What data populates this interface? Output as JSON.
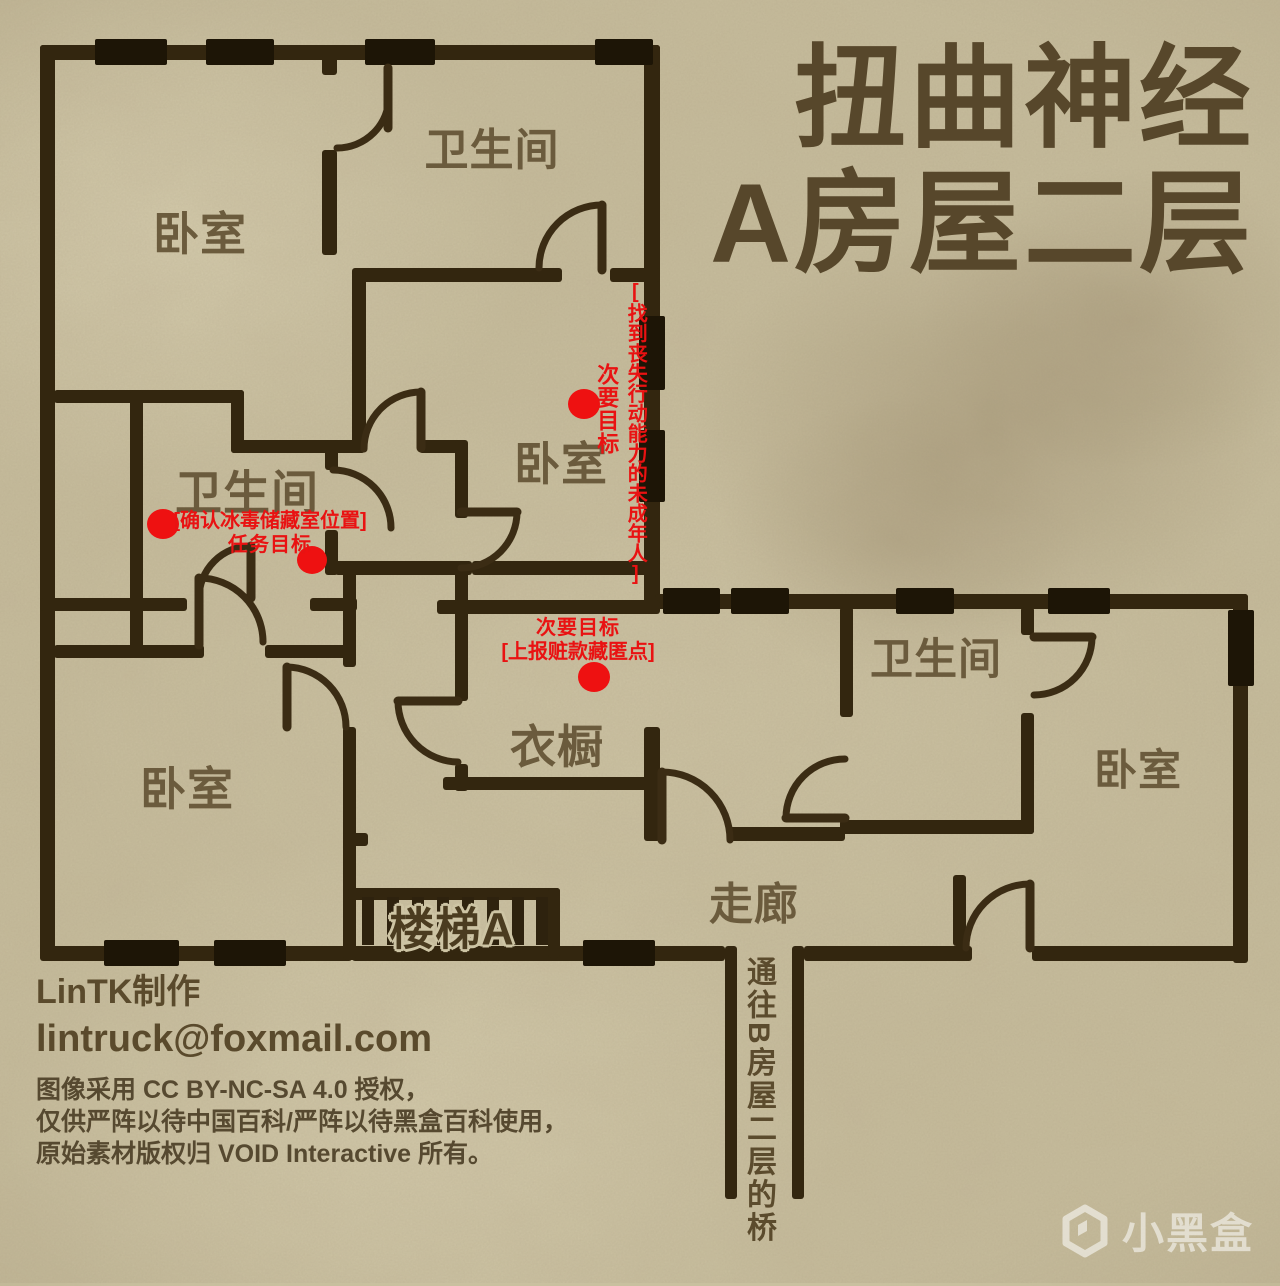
{
  "title": {
    "line1": "扭曲神经",
    "line2": "A房屋二层"
  },
  "rooms": {
    "bedroom_tl": "卧室",
    "bathroom_top": "卫生间",
    "bedroom_tc": "卧室",
    "bathroom_mid": "卫生间",
    "bedroom_bl": "卧室",
    "closet": "衣橱",
    "bathroom_right": "卫生间",
    "bedroom_right": "卧室",
    "corridor": "走廊",
    "stairs": "楼梯A"
  },
  "objectives": {
    "rescue": {
      "bracket": "[找到丧失行动能力的未成年人]",
      "type": "次要目标"
    },
    "meth": {
      "bracket": "[确认冰毒储藏室位置]",
      "type": "任务目标"
    },
    "money": {
      "type": "次要目标",
      "bracket": "[上报赃款藏匿点]"
    }
  },
  "bridge_note": "通往B房屋二层的桥",
  "credits": {
    "author": "LinTK制作",
    "email": "lintruck@foxmail.com",
    "license_line1": "图像采用 CC BY-NC-SA 4.0 授权，",
    "license_line2": "仅供严阵以待中国百科/严阵以待黑盒百科使用，",
    "license_line3": "原始素材版权归 VOID Interactive 所有。"
  },
  "watermark": "小黑盒",
  "colors": {
    "paper": "#c9c09f",
    "wall": "#33260f",
    "window_block": "#1d1506",
    "door_arc": "#3b2c14",
    "label": "#6b5b3d",
    "title": "#57472b",
    "credits": "#5a4a2c",
    "objective_red": "#e91212"
  }
}
